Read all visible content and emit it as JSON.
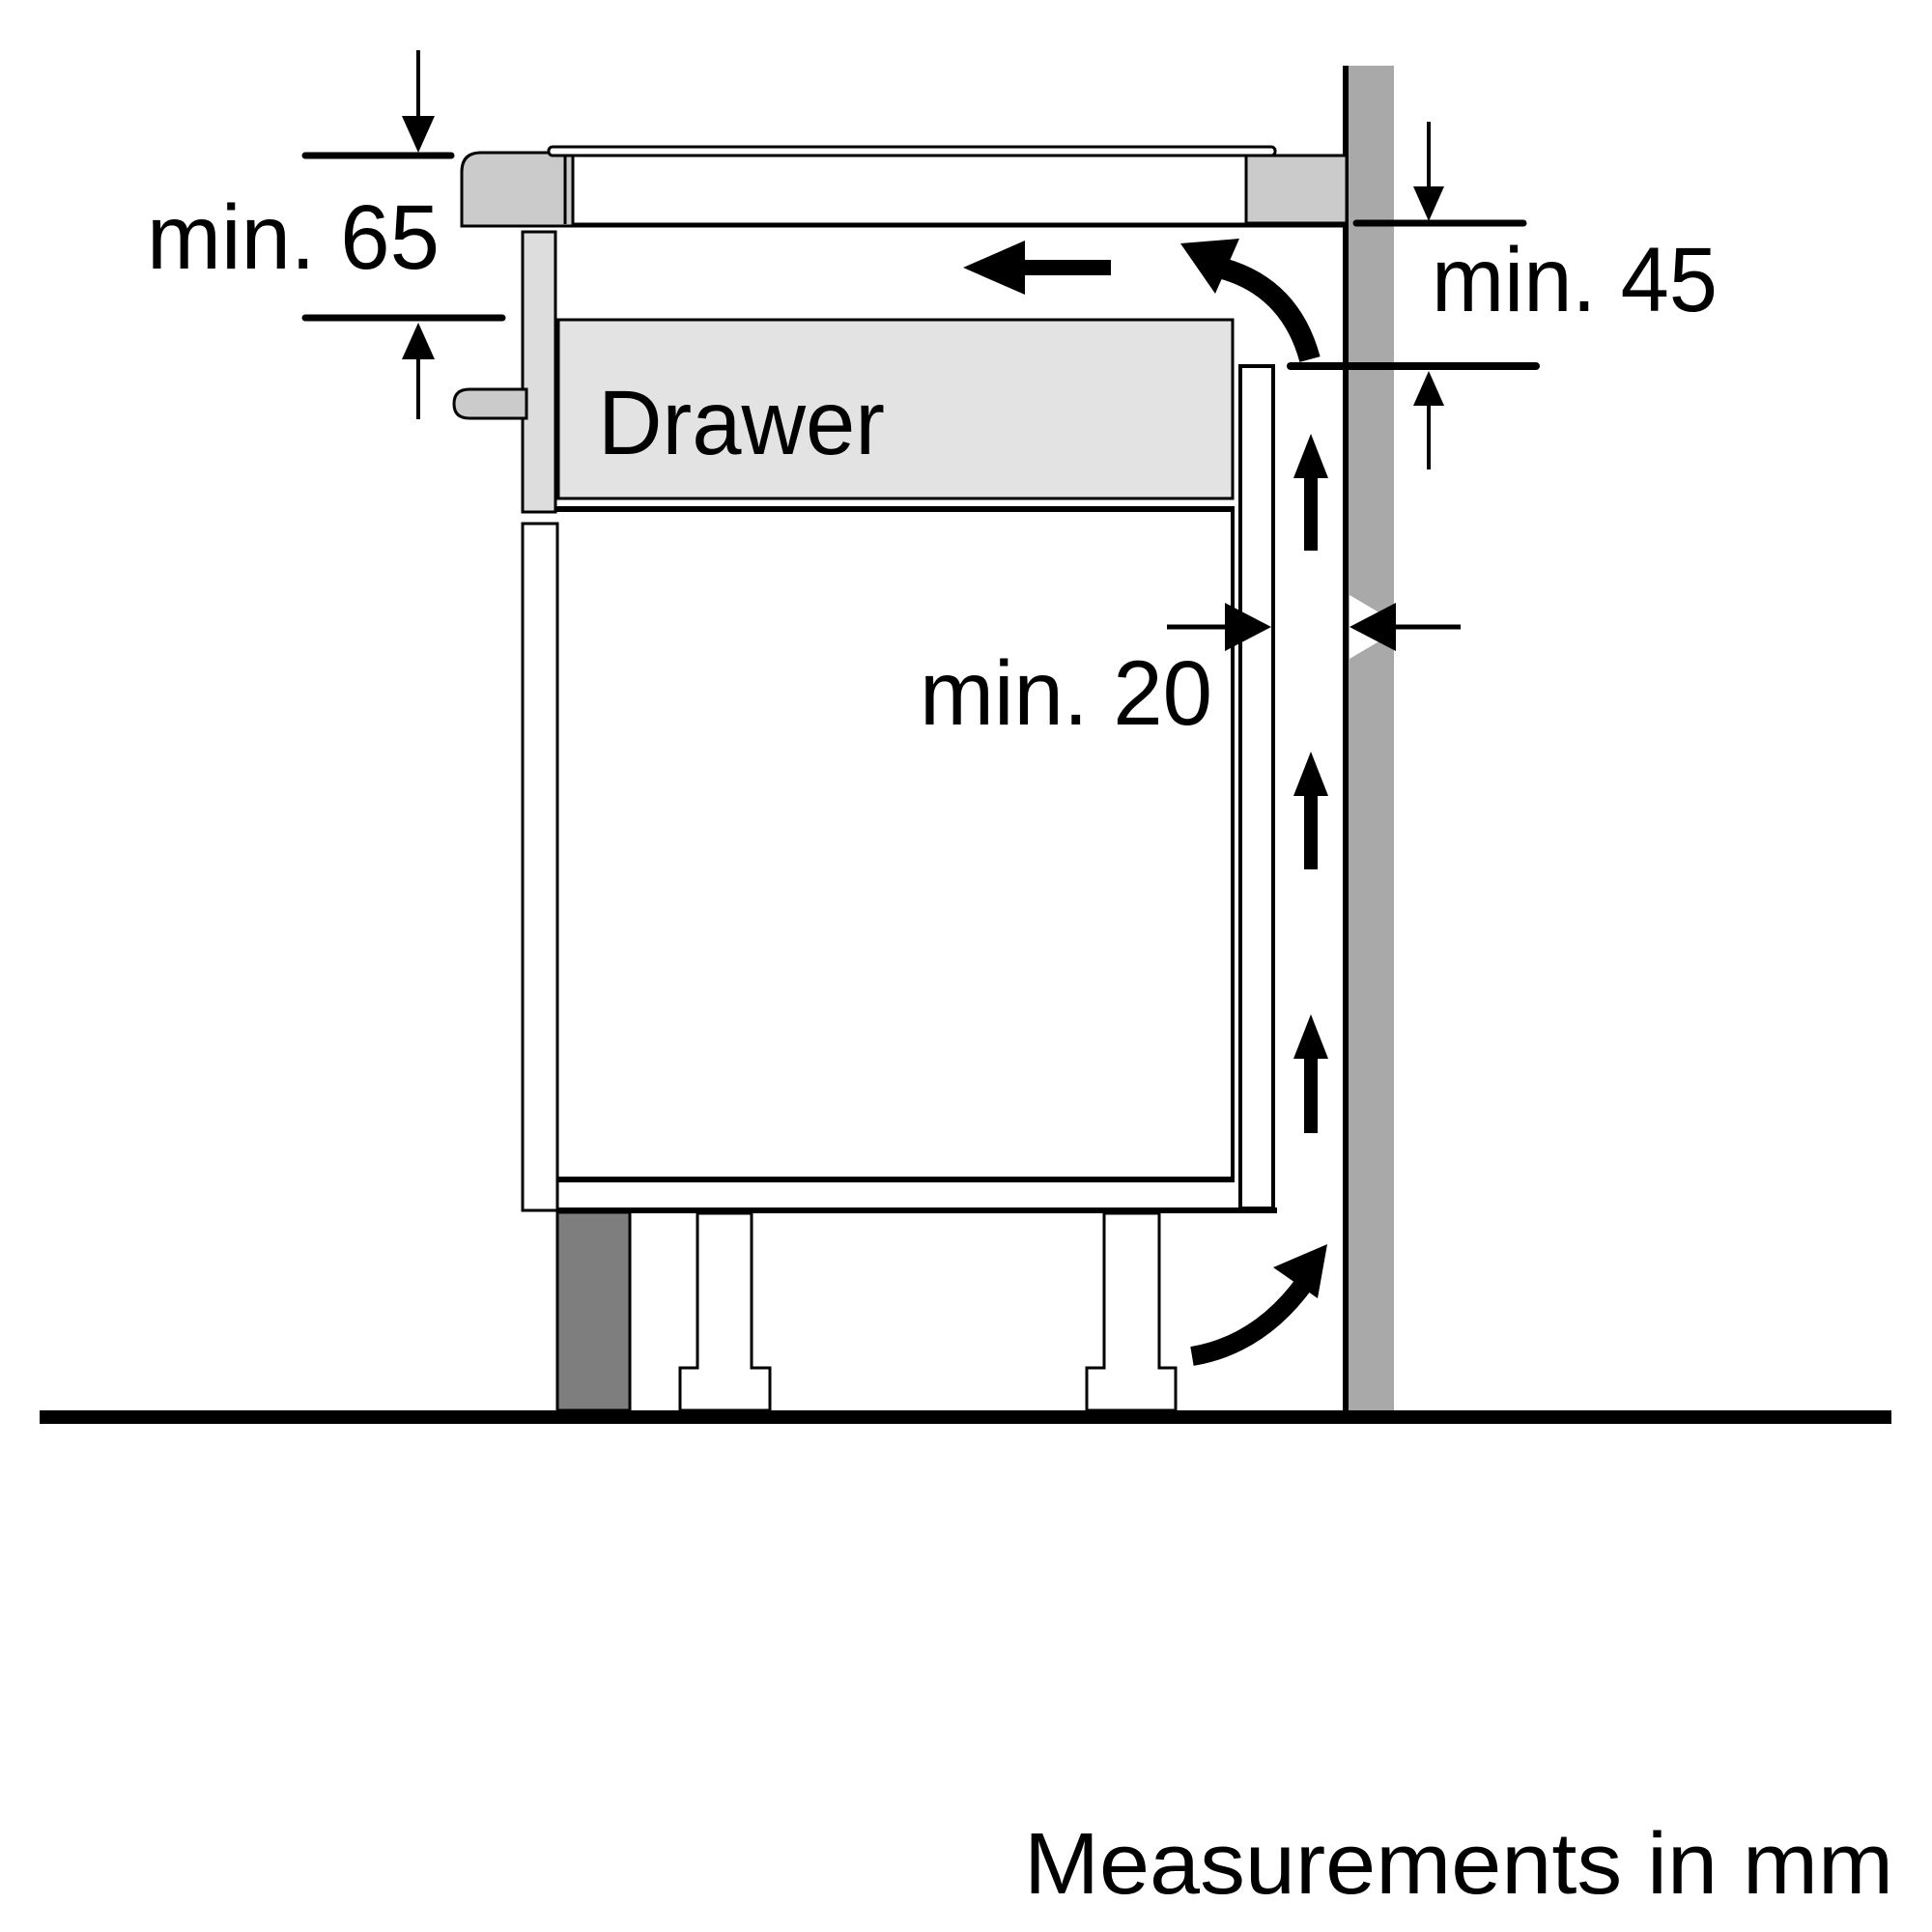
{
  "diagram": {
    "caption": "Measurements in mm",
    "drawer_label": "Drawer",
    "dimensions": {
      "top_clearance": {
        "label": "min. 65"
      },
      "rear_clearance": {
        "label": "min. 45"
      },
      "wall_gap": {
        "label": "min. 20"
      }
    },
    "colors": {
      "background": "#ffffff",
      "wall": "#a9a9a9",
      "appliance_trim": "#cbcbcb",
      "drawer_fill": "#e3e3e3",
      "drawer_front_panel": "#dddddd",
      "plinth_block": "#7e7e7e",
      "line": "#000000"
    },
    "icons": {
      "airflow": [
        "left-arrow-icon",
        "curved-arrow-top-icon",
        "up-arrow-icon",
        "up-arrow-icon",
        "up-arrow-icon",
        "curved-arrow-bottom-icon"
      ]
    }
  }
}
